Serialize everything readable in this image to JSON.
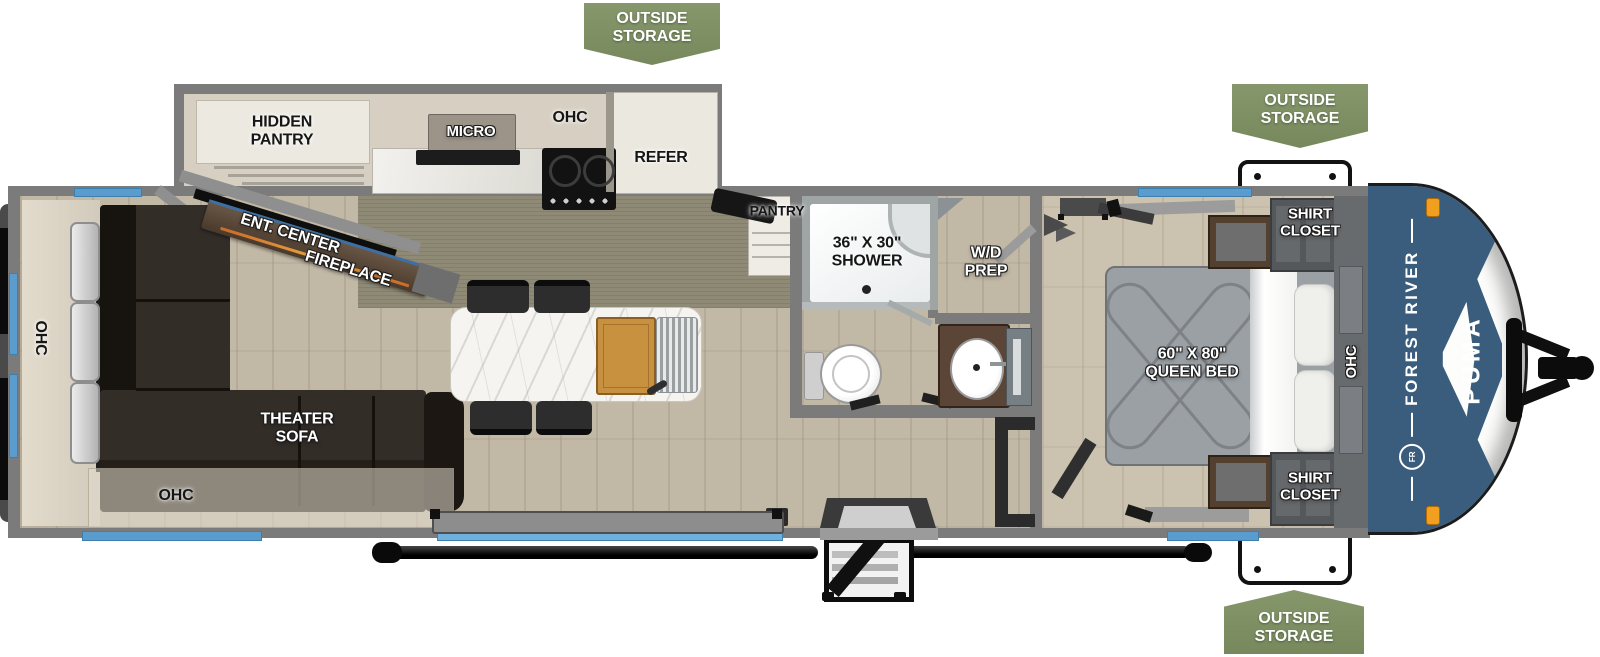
{
  "banners": {
    "top_center": {
      "label": "OUTSIDE\nSTORAGE"
    },
    "top_right": {
      "label": "OUTSIDE\nSTORAGE"
    },
    "bottom_right": {
      "label": "OUTSIDE\nSTORAGE"
    }
  },
  "exterior": {
    "brand": "FOREST RIVER",
    "model": "PUMA",
    "monogram": "FR"
  },
  "rooms": {
    "kitchen": {
      "hidden_pantry": "HIDDEN\nPANTRY",
      "micro": "MICRO",
      "ohc": "OHC",
      "refer": "REFER",
      "pantry": "PANTRY"
    },
    "living": {
      "ent_center": "ENT. CENTER",
      "fireplace": "FIREPLACE",
      "ohc_rear": "OHC",
      "theater_sofa": "THEATER\nSOFA",
      "ohc_bottom": "OHC"
    },
    "bath": {
      "shower": "36\" X 30\"\nSHOWER",
      "wd_prep": "W/D\nPREP"
    },
    "bedroom": {
      "queen_bed": "60\" X 80\"\nQUEEN BED",
      "shirt_closet_top": "SHIRT\nCLOSET",
      "shirt_closet_bottom": "SHIRT\nCLOSET",
      "ohc": "OHC"
    }
  },
  "colors": {
    "banner_green": "#7E9164",
    "window_blue": "#5B9CCE",
    "cap_blue": "#3A5D7D",
    "marker_orange": "#F0A01E",
    "wall_gray": "#7B7B7B",
    "floor_beige": "#C2B8A6"
  }
}
